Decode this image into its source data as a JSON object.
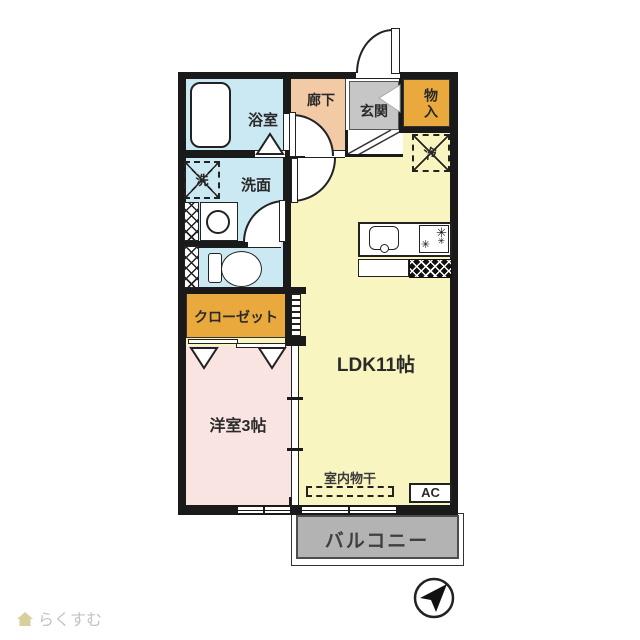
{
  "plan": {
    "rooms": {
      "bath": {
        "label": "浴室",
        "color": "#cbe9f2"
      },
      "corridor": {
        "label": "廊下",
        "color": "#f3caa6"
      },
      "entrance": {
        "label": "玄関",
        "color": "#c6c6c6"
      },
      "storage": {
        "label": "物入",
        "color": "#e9a93d"
      },
      "washroom": {
        "label": "洗面",
        "color": "#cbe9f2"
      },
      "closet": {
        "label": "クローゼット",
        "color": "#e9a93d"
      },
      "western_room": {
        "label": "洋室3帖",
        "color": "#fae4e2"
      },
      "ldk": {
        "label": "LDK11帖",
        "color": "#f8f5c0"
      },
      "balcony": {
        "label": "バルコニー",
        "color": "#b3b3b3"
      }
    },
    "symbols": {
      "washer": "洗",
      "fridge": "冷",
      "indoor_drying": "室内物干",
      "air_conditioner": "AC"
    },
    "wall_color": "#1a1a1a"
  },
  "footer": {
    "logo_text": "らくすむ"
  }
}
